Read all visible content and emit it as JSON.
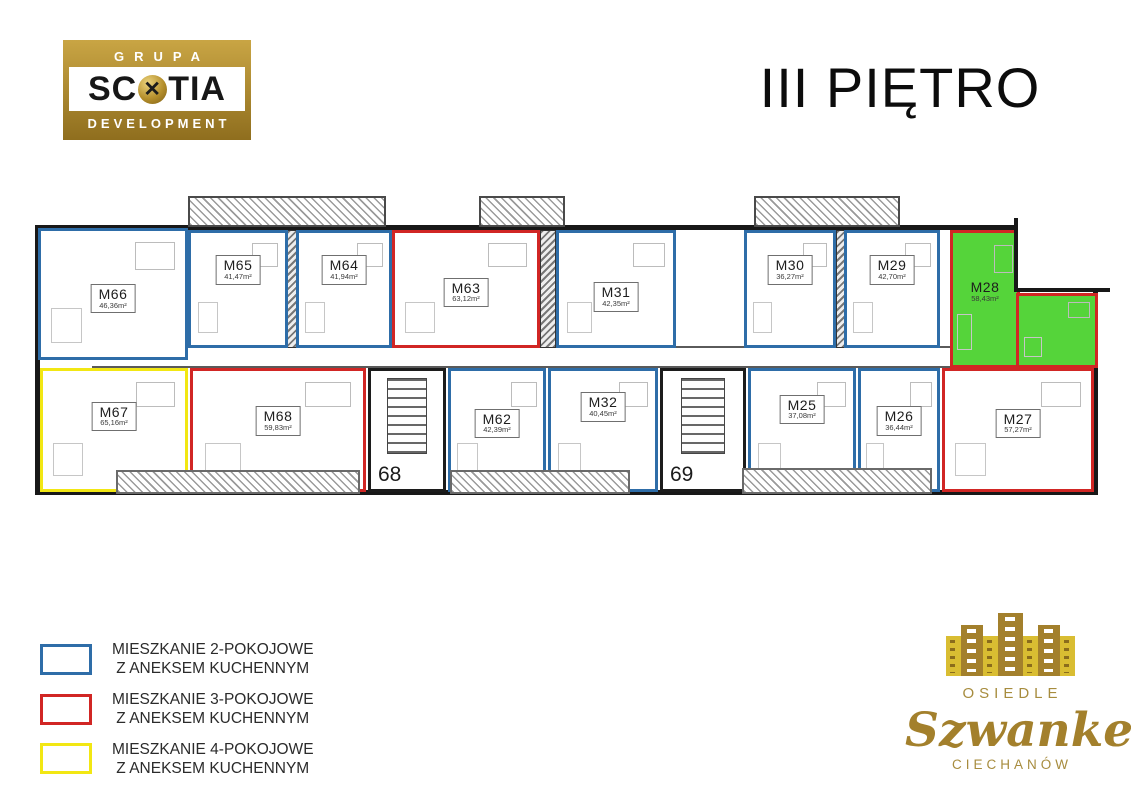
{
  "header": {
    "logo": {
      "line1": "GRUPA",
      "scotia_left": "SC",
      "scotia_right": "TIA",
      "line3": "DEVELOPMENT"
    },
    "title": "III PIĘTRO"
  },
  "colors": {
    "blue": "#2e6da8",
    "red": "#d12624",
    "yellow": "#f2e713",
    "green_highlight": "#55d43a",
    "gold": "#a3802c"
  },
  "floorplan": {
    "stairwells": [
      {
        "label": "68"
      },
      {
        "label": "69"
      }
    ],
    "apartments": [
      {
        "id": "M66",
        "area": "46,36m²",
        "rooms": "2",
        "highlighted": false
      },
      {
        "id": "M65",
        "area": "41,47m²",
        "rooms": "2",
        "highlighted": false
      },
      {
        "id": "M64",
        "area": "41,94m²",
        "rooms": "2",
        "highlighted": false
      },
      {
        "id": "M63",
        "area": "63,12m²",
        "rooms": "3",
        "highlighted": false
      },
      {
        "id": "M31",
        "area": "42,35m²",
        "rooms": "2",
        "highlighted": false
      },
      {
        "id": "M30",
        "area": "36,27m²",
        "rooms": "2",
        "highlighted": false
      },
      {
        "id": "M29",
        "area": "42,70m²",
        "rooms": "2",
        "highlighted": false
      },
      {
        "id": "M28",
        "area": "58,43m²",
        "rooms": "3",
        "highlighted": true
      },
      {
        "id": "M67",
        "area": "65,16m²",
        "rooms": "4",
        "highlighted": false
      },
      {
        "id": "M68",
        "area": "59,83m²",
        "rooms": "3",
        "highlighted": false
      },
      {
        "id": "M62",
        "area": "42,39m²",
        "rooms": "2",
        "highlighted": false
      },
      {
        "id": "M32",
        "area": "40,45m²",
        "rooms": "2",
        "highlighted": false
      },
      {
        "id": "M25",
        "area": "37,08m²",
        "rooms": "2",
        "highlighted": false
      },
      {
        "id": "M26",
        "area": "36,44m²",
        "rooms": "2",
        "highlighted": false
      },
      {
        "id": "M27",
        "area": "57,27m²",
        "rooms": "3",
        "highlighted": false
      }
    ]
  },
  "legend": {
    "items": [
      {
        "color_key": "blue",
        "line1": "MIESZKANIE 2-POKOJOWE",
        "line2": "Z ANEKSEM KUCHENNYM"
      },
      {
        "color_key": "red",
        "line1": "MIESZKANIE 3-POKOJOWE",
        "line2": "Z ANEKSEM KUCHENNYM"
      },
      {
        "color_key": "yellow",
        "line1": "MIESZKANIE 4-POKOJOWE",
        "line2": "Z ANEKSEM KUCHENNYM"
      }
    ]
  },
  "brand": {
    "osiedle": "OSIEDLE",
    "name": "Szwanke",
    "city": "CIECHANÓW"
  }
}
